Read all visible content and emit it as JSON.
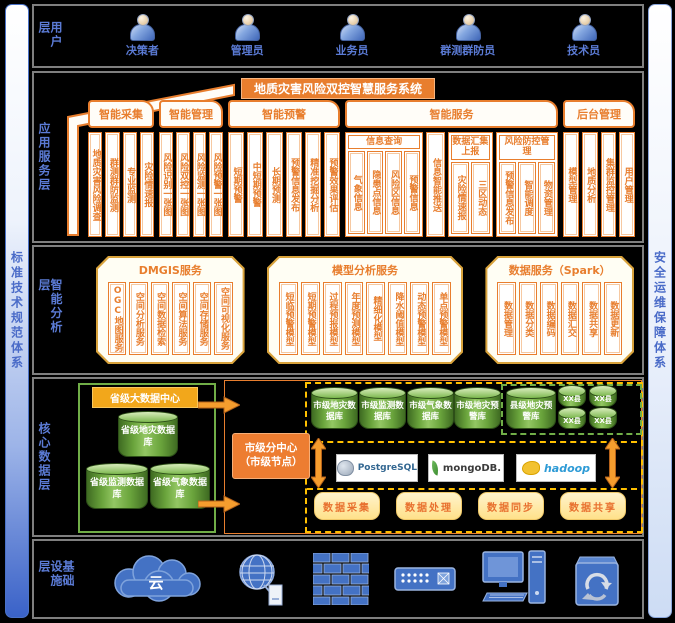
{
  "colors": {
    "orange": "#E87E2E",
    "gold_border": "#D9A33C",
    "label_blue": "#5B7BD5",
    "green": "#70AD47",
    "dashed_yellow": "#FFC000",
    "icon_blue": "#4472C4",
    "button_bg": "#FFE18A",
    "cylinder_green": "#6AA43C",
    "city_center_bg": "#ED7D31",
    "province_title_bg": "#F2A71B"
  },
  "sidebars": {
    "left": "标准技术规范体系",
    "right": "安全运维保障体系"
  },
  "layers": {
    "user": {
      "label": "用户层",
      "users": [
        "决策者",
        "管理员",
        "业务员",
        "群测群防员",
        "技术员"
      ],
      "user_icon": "person-icon"
    },
    "app": {
      "label": "应用服务层",
      "system_title": "地质灾害风险双控智慧服务系统",
      "sections": [
        {
          "tab": "智能采集",
          "items": [
            {
              "type": "col",
              "label": "地质灾害风险调查"
            },
            {
              "type": "col",
              "label": "群测群防监测"
            },
            {
              "type": "col",
              "label": "专业监测"
            },
            {
              "type": "col",
              "label": "灾险情速报"
            }
          ]
        },
        {
          "tab": "智能管理",
          "items": [
            {
              "type": "col",
              "label": "风险识别一张图"
            },
            {
              "type": "col",
              "label": "风险双控一张图"
            },
            {
              "type": "col",
              "label": "风险监测一张图"
            },
            {
              "type": "col",
              "label": "风险预警一张图"
            }
          ]
        },
        {
          "tab": "智能预警",
          "items": [
            {
              "type": "col",
              "label": "短期预警"
            },
            {
              "type": "col",
              "label": "中短期预警"
            },
            {
              "type": "col",
              "label": "长期预测"
            },
            {
              "type": "col",
              "label": "预警信息发布"
            },
            {
              "type": "col",
              "label": "精准挖掘分析"
            },
            {
              "type": "col",
              "label": "预警效果评估"
            }
          ]
        },
        {
          "tab": "智能服务",
          "items": [
            {
              "type": "group",
              "header": "信息查询",
              "columns": [
                "气象信息",
                "隐患点信息",
                "风险区信息",
                "预警信息"
              ]
            },
            {
              "type": "col",
              "label": "信息智能推送"
            },
            {
              "type": "group",
              "header": "数据汇集上报",
              "columns": [
                "灾险情速报",
                "三区动态"
              ]
            },
            {
              "type": "group",
              "header": "风险防控管理",
              "columns": [
                "预警信息发布",
                "智能调度",
                "物资管理"
              ]
            }
          ]
        },
        {
          "tab": "后台管理",
          "items": [
            {
              "type": "col",
              "label": "模型管理"
            },
            {
              "type": "col",
              "label": "地质分析"
            },
            {
              "type": "col",
              "label": "集群监控管理"
            },
            {
              "type": "col",
              "label": "用户管理"
            }
          ]
        }
      ]
    },
    "analysis": {
      "label": "智能分析层",
      "boxes": [
        {
          "title": "DMGIS服务",
          "columns": [
            "OGC地图服务",
            "空间分析服务",
            "空间数据检索",
            "空间算法服务",
            "空间存储服务",
            "空间可视化服务"
          ]
        },
        {
          "title": "模型分析服务",
          "columns": [
            "短临预警模型",
            "短期预警模型",
            "过程预报模型",
            "年度预测模型",
            "精细化模型",
            "降水阈值模型",
            "动态预警模型",
            "单点预警模型"
          ]
        },
        {
          "title": "数据服务（Spark）",
          "columns": [
            "数据管理",
            "数据分类",
            "数据编码",
            "数据汇交",
            "数据共享",
            "数据更新"
          ]
        }
      ]
    },
    "data": {
      "label": "核心数据层",
      "province": {
        "title": "省级大数据中心",
        "cylinders": [
          "省级地灾数据库",
          "省级监测数据库",
          "省级气象数据库"
        ]
      },
      "city_center": {
        "line1": "市级分中心",
        "line2": "（市级节点）"
      },
      "city_cylinders": [
        "市级地灾数据库",
        "市级监测数据库",
        "市级气象数据库",
        "市级地灾预警库"
      ],
      "county": {
        "main": "县级地灾预警库",
        "small": [
          "XX县",
          "XX县",
          "XX县",
          "XX县"
        ]
      },
      "logos": [
        {
          "name": "postgresql-logo",
          "label": "PostgreSQL"
        },
        {
          "name": "mongodb-logo",
          "label": "mongoDB."
        },
        {
          "name": "hadoop-logo",
          "label": "hadoop"
        }
      ],
      "process_buttons": [
        "数据采集",
        "数据处理",
        "数据同步",
        "数据共享"
      ]
    },
    "infra": {
      "label": "基础设施层",
      "cloud_label": "云",
      "icons": [
        "cloud-icon",
        "globe-network-icon",
        "firewall-icon",
        "network-switch-icon",
        "workstation-icon",
        "server-recycle-icon"
      ]
    }
  }
}
